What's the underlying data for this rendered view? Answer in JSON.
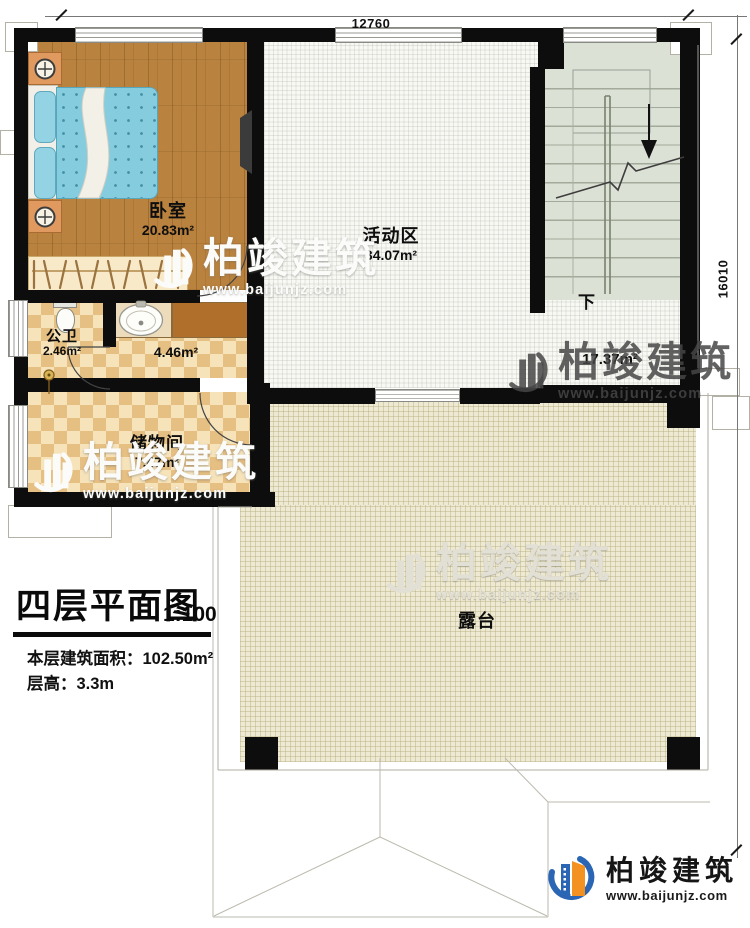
{
  "title_block": {
    "title": "四层平面图",
    "scale": "1:100",
    "floor_area": "本层建筑面积：102.50m²",
    "floor_height": "层高：3.3m"
  },
  "dimensions": {
    "top": "12760",
    "right": "16010"
  },
  "rooms": {
    "bedroom": {
      "name": "卧室",
      "area": "20.83m²"
    },
    "activity": {
      "name": "活动区",
      "area": "34.07m²"
    },
    "bathroom": {
      "name": "公卫",
      "area": "2.46m²"
    },
    "corridor": {
      "area": "4.46m²"
    },
    "storage": {
      "name": "储物间",
      "area": "7.47m²"
    },
    "stair_hall": {
      "area": "17.37m²"
    },
    "terrace": {
      "name": "露台"
    }
  },
  "stairs": {
    "down_label": "下"
  },
  "watermark": {
    "brand": "柏竣建筑",
    "website": "www.baijunjz.com"
  },
  "logo": {
    "brand": "柏竣建筑",
    "website": "www.baijunjz.com"
  },
  "colors": {
    "wall": "#0d0d0d",
    "wood_floor": "#b9823f",
    "tile_light": "#f6e3ba",
    "tile_dark": "#e6bf82",
    "terrace_floor": "#ede9d3",
    "stair_floor": "#dce1d6",
    "bed": "#85ccdf",
    "counter_brown": "#b06f2a",
    "brand_blue": "#2b66b5",
    "brand_orange": "#f49221"
  }
}
